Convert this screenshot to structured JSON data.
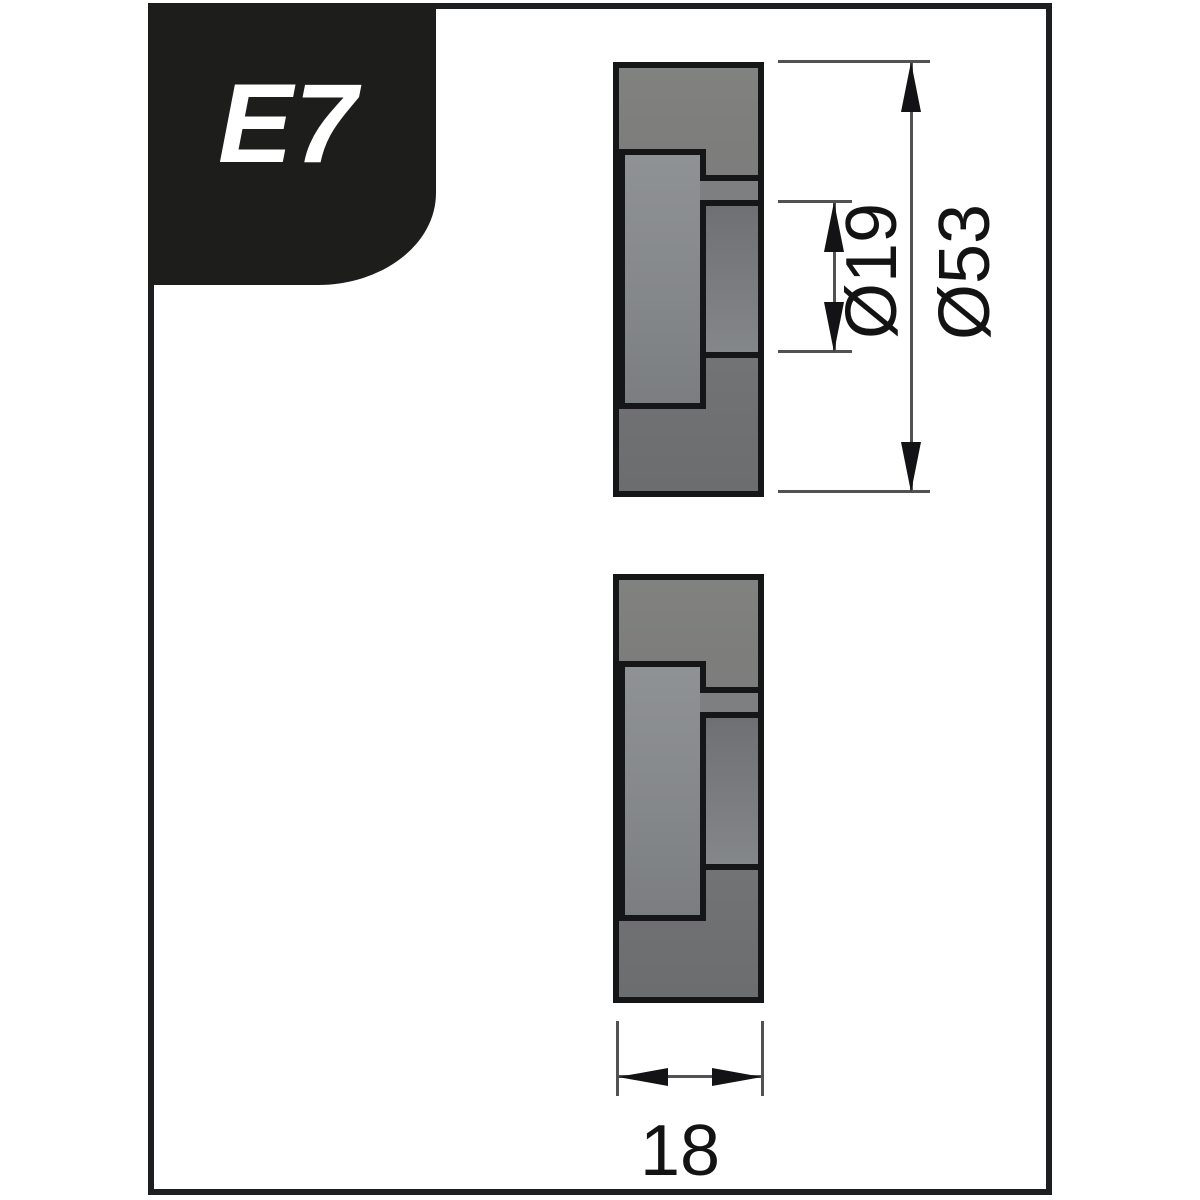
{
  "badge": {
    "label": "E7"
  },
  "drawing": {
    "description": "bending roller cross-sections, two identical profile views",
    "views": [
      "upper-roller-section",
      "lower-roller-section"
    ],
    "dimensions": {
      "bore_diameter": {
        "label": "Ø19",
        "value": 19
      },
      "outer_diameter": {
        "label": "Ø53",
        "value": 53
      },
      "width": {
        "label": "18",
        "value": 18
      }
    }
  },
  "colors": {
    "canvas_bg": "#ffffff",
    "frame_border": "#1c1e20",
    "badge_bg": "#1d1d1b",
    "badge_text": "#ffffff",
    "part_outline": "#141618",
    "part_body_fill": "#757677",
    "part_bushing_fill": "#86898b",
    "dim_line": "#515254",
    "dim_text": "#131313"
  }
}
